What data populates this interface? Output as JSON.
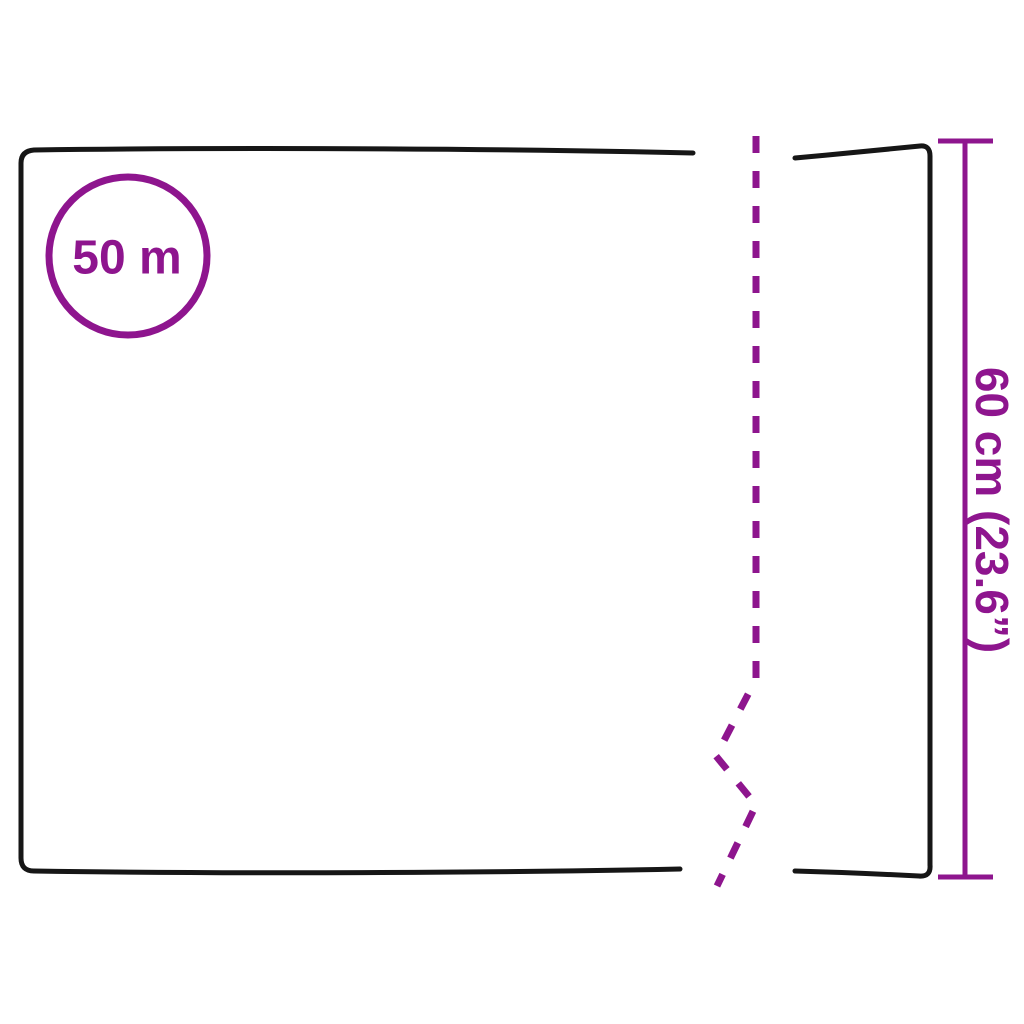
{
  "diagram": {
    "type": "product-dimension-diagram",
    "subject": "roll-of-sheet-material",
    "length_label": "50 m",
    "width_label": "60 cm (23.6”)"
  },
  "colors": {
    "accent_purple": "#8E158E",
    "line_black": "#161616",
    "background": "#FFFFFF"
  }
}
